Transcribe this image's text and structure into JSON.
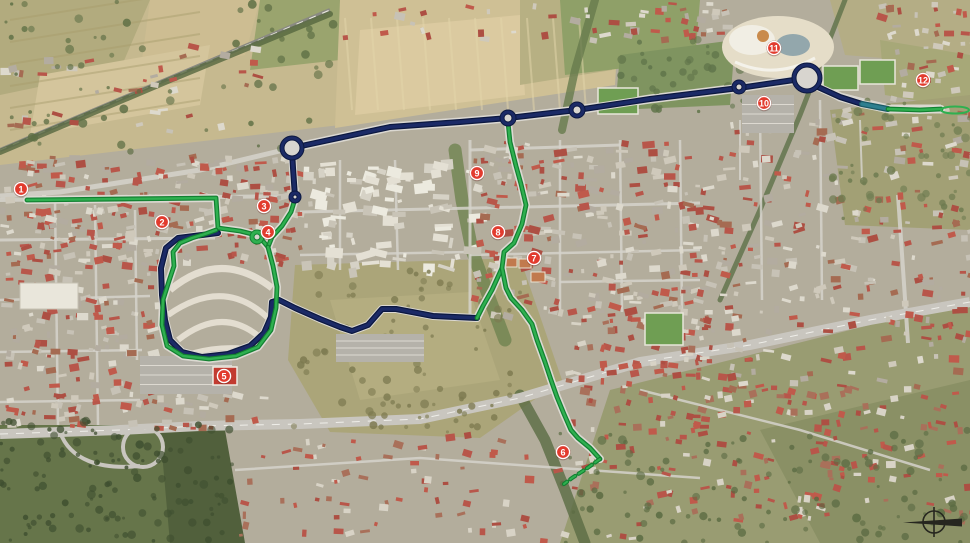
{
  "map": {
    "colors": {
      "marker_fill": "#e23b2e",
      "marker_ring": "#ffffff",
      "marker_edge": "#8d1f14",
      "navy": "#1b2a66",
      "navy_edge": "#0c1840",
      "teal": "#2e7f8f",
      "teal_edge": "#1b5a66",
      "green": "#2fb050",
      "green_edge": "#128031",
      "compass": "#26261f"
    },
    "markers": [
      {
        "label": "1",
        "x": 21,
        "y": 189
      },
      {
        "label": "2",
        "x": 162,
        "y": 222
      },
      {
        "label": "3",
        "x": 264,
        "y": 206
      },
      {
        "label": "4",
        "x": 268,
        "y": 232
      },
      {
        "label": "5",
        "x": 224,
        "y": 376
      },
      {
        "label": "6",
        "x": 563,
        "y": 452
      },
      {
        "label": "7",
        "x": 534,
        "y": 258
      },
      {
        "label": "8",
        "x": 498,
        "y": 232
      },
      {
        "label": "9",
        "x": 477,
        "y": 173
      },
      {
        "label": "10",
        "x": 764,
        "y": 103
      },
      {
        "label": "11",
        "x": 774,
        "y": 48
      },
      {
        "label": "12",
        "x": 923,
        "y": 80
      }
    ],
    "routes": {
      "navy_paths": [
        [
          [
            295,
            197
          ],
          [
            293,
            168
          ],
          [
            292,
            150
          ]
        ],
        [
          [
            292,
            148
          ],
          [
            390,
            127
          ],
          [
            460,
            122
          ],
          [
            508,
            118
          ],
          [
            577,
            110
          ],
          [
            650,
            99
          ],
          [
            739,
            88
          ],
          [
            794,
            80
          ]
        ],
        [
          [
            818,
            87
          ],
          [
            840,
            97
          ],
          [
            862,
            104
          ]
        ],
        [
          [
            218,
            233
          ],
          [
            178,
            238
          ],
          [
            166,
            248
          ],
          [
            161,
            268
          ],
          [
            162,
            295
          ],
          [
            165,
            320
          ],
          [
            170,
            340
          ],
          [
            182,
            352
          ],
          [
            202,
            357
          ],
          [
            228,
            354
          ],
          [
            250,
            346
          ],
          [
            264,
            333
          ],
          [
            271,
            317
          ],
          [
            272,
            302
          ],
          [
            279,
            300
          ],
          [
            295,
            308
          ],
          [
            320,
            319
          ],
          [
            340,
            327
          ],
          [
            352,
            331
          ],
          [
            368,
            325
          ],
          [
            382,
            309
          ],
          [
            396,
            309
          ],
          [
            412,
            312
          ],
          [
            433,
            316
          ],
          [
            477,
            318
          ]
        ]
      ],
      "teal_paths": [
        [
          [
            862,
            104
          ],
          [
            888,
            109
          ]
        ]
      ],
      "green_paths": [
        [
          [
            27,
            200
          ],
          [
            216,
            198
          ],
          [
            218,
            228
          ],
          [
            240,
            231
          ],
          [
            252,
            234
          ],
          [
            262,
            240
          ],
          [
            268,
            247
          ]
        ],
        [
          [
            295,
            199
          ],
          [
            291,
            212
          ],
          [
            282,
            226
          ],
          [
            272,
            237
          ],
          [
            268,
            247
          ]
        ],
        [
          [
            268,
            247
          ],
          [
            273,
            266
          ],
          [
            277,
            287
          ],
          [
            276,
            308
          ],
          [
            271,
            330
          ],
          [
            258,
            347
          ],
          [
            236,
            356
          ],
          [
            209,
            359
          ],
          [
            183,
            356
          ],
          [
            167,
            346
          ],
          [
            162,
            325
          ],
          [
            163,
            300
          ],
          [
            169,
            281
          ],
          [
            174,
            266
          ],
          [
            173,
            252
          ],
          [
            180,
            243
          ],
          [
            192,
            238
          ],
          [
            205,
            234
          ],
          [
            216,
            230
          ]
        ],
        [
          [
            502,
            268
          ],
          [
            492,
            290
          ],
          [
            483,
            306
          ],
          [
            477,
            318
          ]
        ],
        [
          [
            508,
            122
          ],
          [
            510,
            142
          ],
          [
            516,
            166
          ],
          [
            521,
            184
          ],
          [
            526,
            205
          ],
          [
            522,
            224
          ],
          [
            514,
            243
          ],
          [
            504,
            252
          ],
          [
            502,
            268
          ],
          [
            506,
            288
          ],
          [
            511,
            298
          ],
          [
            522,
            310
          ],
          [
            532,
            324
          ],
          [
            537,
            340
          ],
          [
            545,
            362
          ],
          [
            551,
            380
          ],
          [
            557,
            397
          ],
          [
            564,
            414
          ],
          [
            571,
            430
          ],
          [
            578,
            438
          ],
          [
            590,
            448
          ],
          [
            600,
            459
          ]
        ],
        [
          [
            888,
            109
          ],
          [
            920,
            110
          ],
          [
            941,
            109
          ]
        ]
      ],
      "green_dashed_paths": [
        [
          [
            600,
            459
          ],
          [
            586,
            469
          ],
          [
            572,
            478
          ],
          [
            564,
            484
          ]
        ]
      ],
      "terminal_loop": {
        "cx": 955,
        "cy": 110,
        "rx": 14,
        "ry": 3.5
      }
    },
    "roundabouts": [
      {
        "x": 292,
        "y": 148,
        "r": 10,
        "line": "navy"
      },
      {
        "x": 508,
        "y": 118,
        "r": 6,
        "line": "navy"
      },
      {
        "x": 577,
        "y": 110,
        "r": 6,
        "line": "navy"
      },
      {
        "x": 739,
        "y": 87,
        "r": 5,
        "line": "navy"
      },
      {
        "x": 807,
        "y": 78,
        "r": 13,
        "line": "navy"
      },
      {
        "x": 295,
        "y": 197,
        "r": 4,
        "line": "navy"
      },
      {
        "x": 257,
        "y": 237,
        "r": 5,
        "line": "green"
      }
    ],
    "compass": {
      "x": 934,
      "y": 522
    }
  }
}
